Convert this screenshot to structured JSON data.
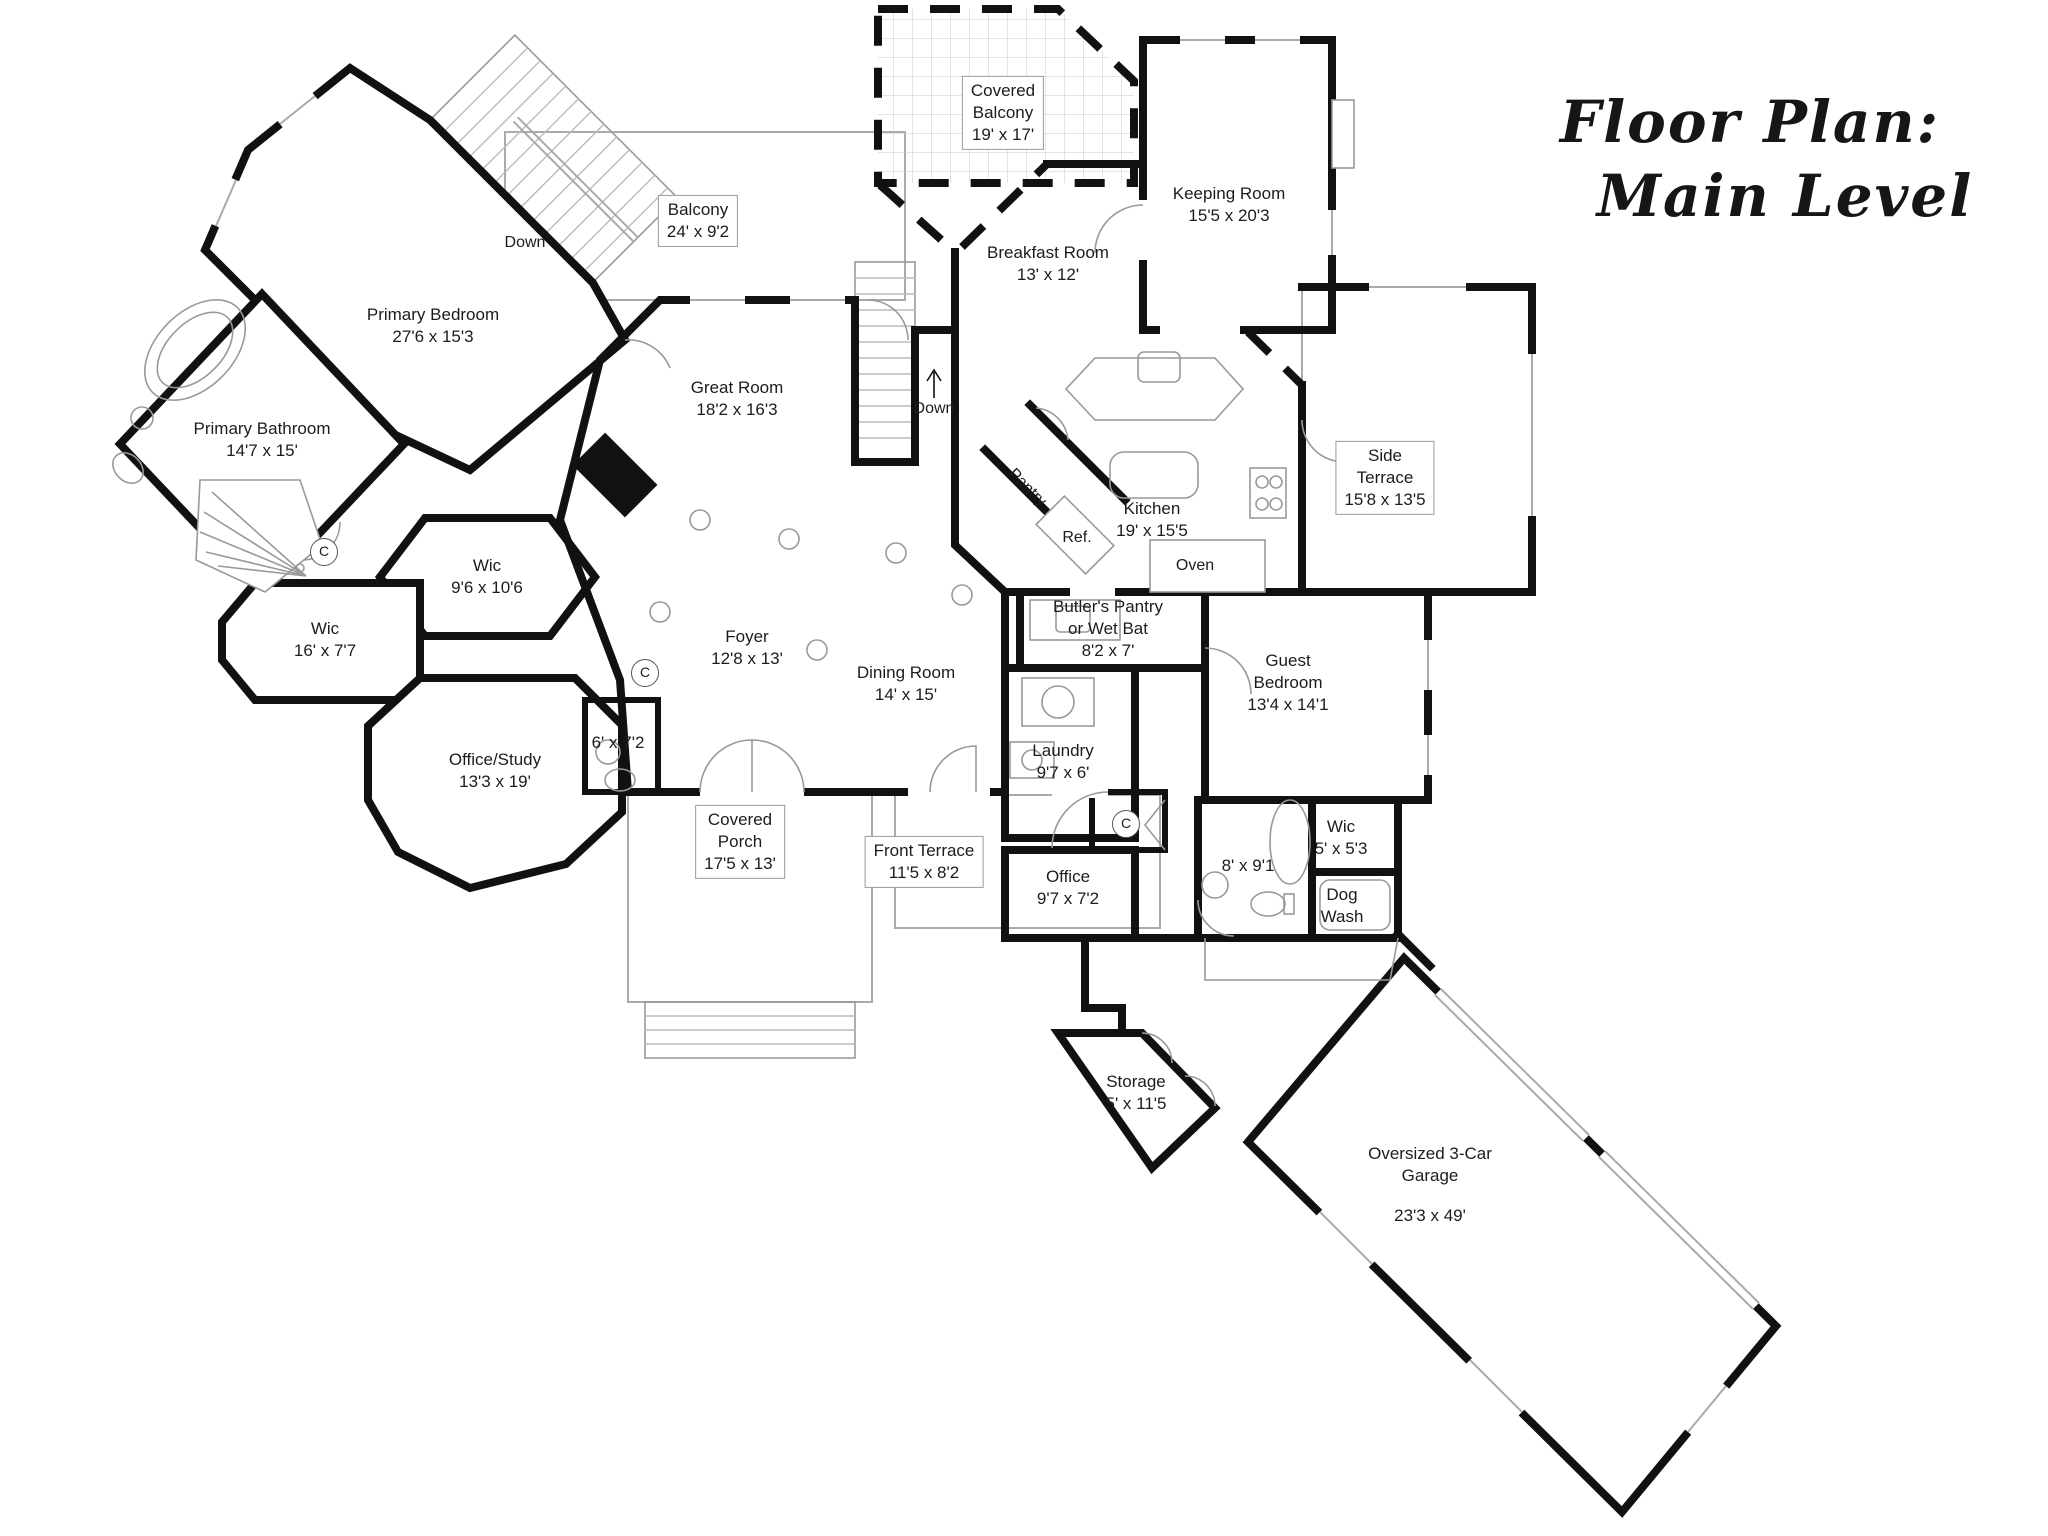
{
  "title": {
    "line1": "Floor Plan:",
    "line2": "Main Level"
  },
  "colors": {
    "wall": "#111111",
    "thin_line": "#999999",
    "tile_grid": "#c9c9c9",
    "text": "#1c1c1c",
    "background": "#ffffff"
  },
  "rooms": [
    {
      "id": "covered-balcony",
      "name": "Covered\nBalcony",
      "dims": "19' x 17'",
      "x": 1003,
      "y": 113,
      "boxed": true
    },
    {
      "id": "balcony",
      "name": "Balcony",
      "dims": "24' x 9'2",
      "x": 698,
      "y": 221,
      "boxed": true
    },
    {
      "id": "keeping-room",
      "name": "Keeping  Room",
      "dims": "15'5 x 20'3",
      "x": 1229,
      "y": 205,
      "boxed": false
    },
    {
      "id": "breakfast-room",
      "name": "Breakfast Room",
      "dims": "13' x 12'",
      "x": 1048,
      "y": 264,
      "boxed": false
    },
    {
      "id": "primary-bedroom",
      "name": "Primary Bedroom",
      "dims": "27'6 x 15'3",
      "x": 433,
      "y": 326,
      "boxed": false
    },
    {
      "id": "great-room",
      "name": "Great Room",
      "dims": "18'2 x 16'3",
      "x": 737,
      "y": 399,
      "boxed": false
    },
    {
      "id": "primary-bathroom",
      "name": "Primary Bathroom",
      "dims": "14'7 x 15'",
      "x": 262,
      "y": 440,
      "boxed": false
    },
    {
      "id": "side-terrace",
      "name": "Side\nTerrace",
      "dims": "15'8 x 13'5",
      "x": 1385,
      "y": 478,
      "boxed": true
    },
    {
      "id": "kitchen",
      "name": "Kitchen",
      "dims": "19' x 15'5",
      "x": 1152,
      "y": 520,
      "boxed": false
    },
    {
      "id": "wic-primary-1",
      "name": "Wic",
      "dims": "9'6 x 10'6",
      "x": 487,
      "y": 577,
      "boxed": false
    },
    {
      "id": "wic-primary-2",
      "name": "Wic",
      "dims": "16' x 7'7",
      "x": 325,
      "y": 640,
      "boxed": false
    },
    {
      "id": "butlers-pantry",
      "name": "Butler's Pantry\nor Wet Bat",
      "dims": "8'2 x 7'",
      "x": 1108,
      "y": 629,
      "boxed": false
    },
    {
      "id": "guest-bedroom",
      "name": "Guest\nBedroom",
      "dims": "13'4 x 14'1",
      "x": 1288,
      "y": 683,
      "boxed": false
    },
    {
      "id": "foyer",
      "name": "Foyer",
      "dims": "12'8 x 13'",
      "x": 747,
      "y": 648,
      "boxed": false
    },
    {
      "id": "dining-room",
      "name": "Dining Room",
      "dims": "14' x 15'",
      "x": 906,
      "y": 684,
      "boxed": false
    },
    {
      "id": "laundry",
      "name": "Laundry",
      "dims": "9'7 x 6'",
      "x": 1063,
      "y": 762,
      "boxed": false
    },
    {
      "id": "powder-room",
      "name": "",
      "dims": "6' x 7'2",
      "x": 618,
      "y": 743,
      "boxed": false
    },
    {
      "id": "office-study",
      "name": "Office/Study",
      "dims": "13'3 x 19'",
      "x": 495,
      "y": 771,
      "boxed": false
    },
    {
      "id": "covered-porch",
      "name": "Covered\nPorch",
      "dims": "17'5 x 13'",
      "x": 740,
      "y": 842,
      "boxed": true
    },
    {
      "id": "front-terrace",
      "name": "Front Terrace",
      "dims": "11'5 x 8'2",
      "x": 924,
      "y": 862,
      "boxed": true
    },
    {
      "id": "office",
      "name": "Office",
      "dims": "9'7 x 7'2",
      "x": 1068,
      "y": 888,
      "boxed": false
    },
    {
      "id": "guest-bathroom",
      "name": "",
      "dims": "8' x 9'1",
      "x": 1248,
      "y": 866,
      "boxed": false
    },
    {
      "id": "wic-guest",
      "name": "Wic",
      "dims": "5' x 5'3",
      "x": 1341,
      "y": 838,
      "boxed": false
    },
    {
      "id": "dog-wash",
      "name": "Dog\nWash",
      "dims": "",
      "x": 1342,
      "y": 906,
      "boxed": false
    },
    {
      "id": "storage",
      "name": "Storage",
      "dims": "5' x 11'5",
      "x": 1136,
      "y": 1093,
      "boxed": false
    },
    {
      "id": "garage",
      "name": "Oversized 3-Car\nGarage",
      "dims": "23'3 x 49'",
      "x": 1430,
      "y": 1185,
      "boxed": false,
      "dims_gap": true
    }
  ],
  "annotations": [
    {
      "id": "down-upper-stairs",
      "text": "Down",
      "x": 525,
      "y": 243,
      "circled": false
    },
    {
      "id": "down-lower-stairs",
      "text": "Down",
      "x": 934,
      "y": 409,
      "circled": false
    },
    {
      "id": "pantry",
      "text": "Pantry",
      "x": 1027,
      "y": 488,
      "rotate": 45,
      "circled": false
    },
    {
      "id": "refrigerator",
      "text": "Ref.",
      "x": 1077,
      "y": 538,
      "circled": false
    },
    {
      "id": "oven",
      "text": "Oven",
      "x": 1195,
      "y": 566,
      "circled": false
    },
    {
      "id": "closet-1",
      "text": "C",
      "x": 324,
      "y": 552,
      "circled": true
    },
    {
      "id": "closet-2",
      "text": "C",
      "x": 645,
      "y": 673,
      "circled": true
    },
    {
      "id": "closet-3",
      "text": "C",
      "x": 1126,
      "y": 824,
      "circled": true
    }
  ]
}
